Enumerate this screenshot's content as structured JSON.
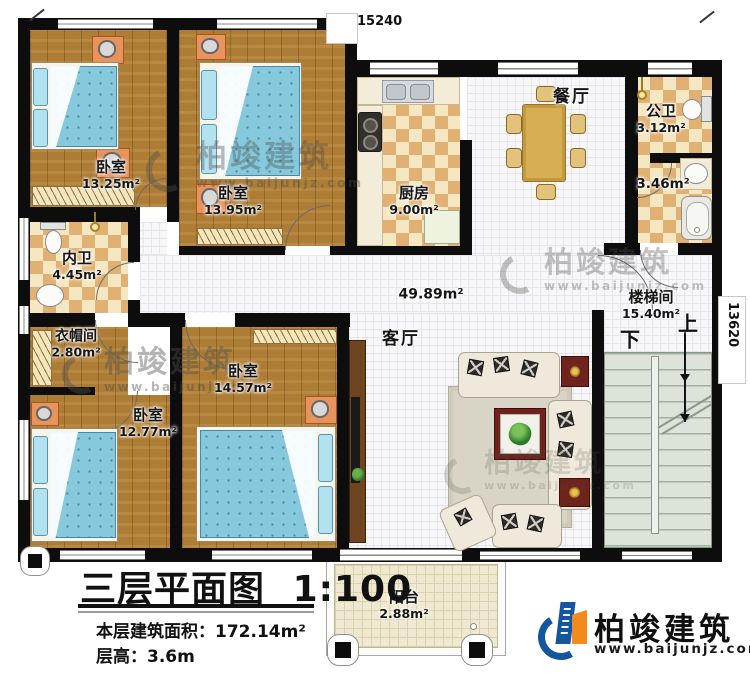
{
  "dimensions": {
    "top": "15240",
    "right": "13620"
  },
  "rooms": [
    {
      "name": "卧室",
      "area": "13.25m²"
    },
    {
      "name": "卧室",
      "area": "13.95m²"
    },
    {
      "name": "厨房",
      "area": "9.00m²"
    },
    {
      "name": "餐厅",
      "area": ""
    },
    {
      "name": "公卫",
      "area": "3.12m²"
    },
    {
      "name": "",
      "area": "3.46m²"
    },
    {
      "name": "内卫",
      "area": "4.45m²"
    },
    {
      "name": "客厅",
      "area": "49.89m²"
    },
    {
      "name": "楼梯间",
      "area": "15.40m²"
    },
    {
      "name": "衣帽间",
      "area": "2.80m²"
    },
    {
      "name": "卧室",
      "area": "14.57m²"
    },
    {
      "name": "卧室",
      "area": "12.77m²"
    },
    {
      "name": "阳台",
      "area": "2.88m²"
    }
  ],
  "stairs": {
    "up": "上",
    "down": "下"
  },
  "title_block": {
    "title": "三层平面图",
    "scale": "1:100",
    "area_label": "本层建筑面积：",
    "area_value": "172.14m²",
    "floor_height_label": "层高：",
    "floor_height_value": "3.6m"
  },
  "branding": {
    "name": "柏竣建筑",
    "url": "www.baijunjz.com"
  }
}
